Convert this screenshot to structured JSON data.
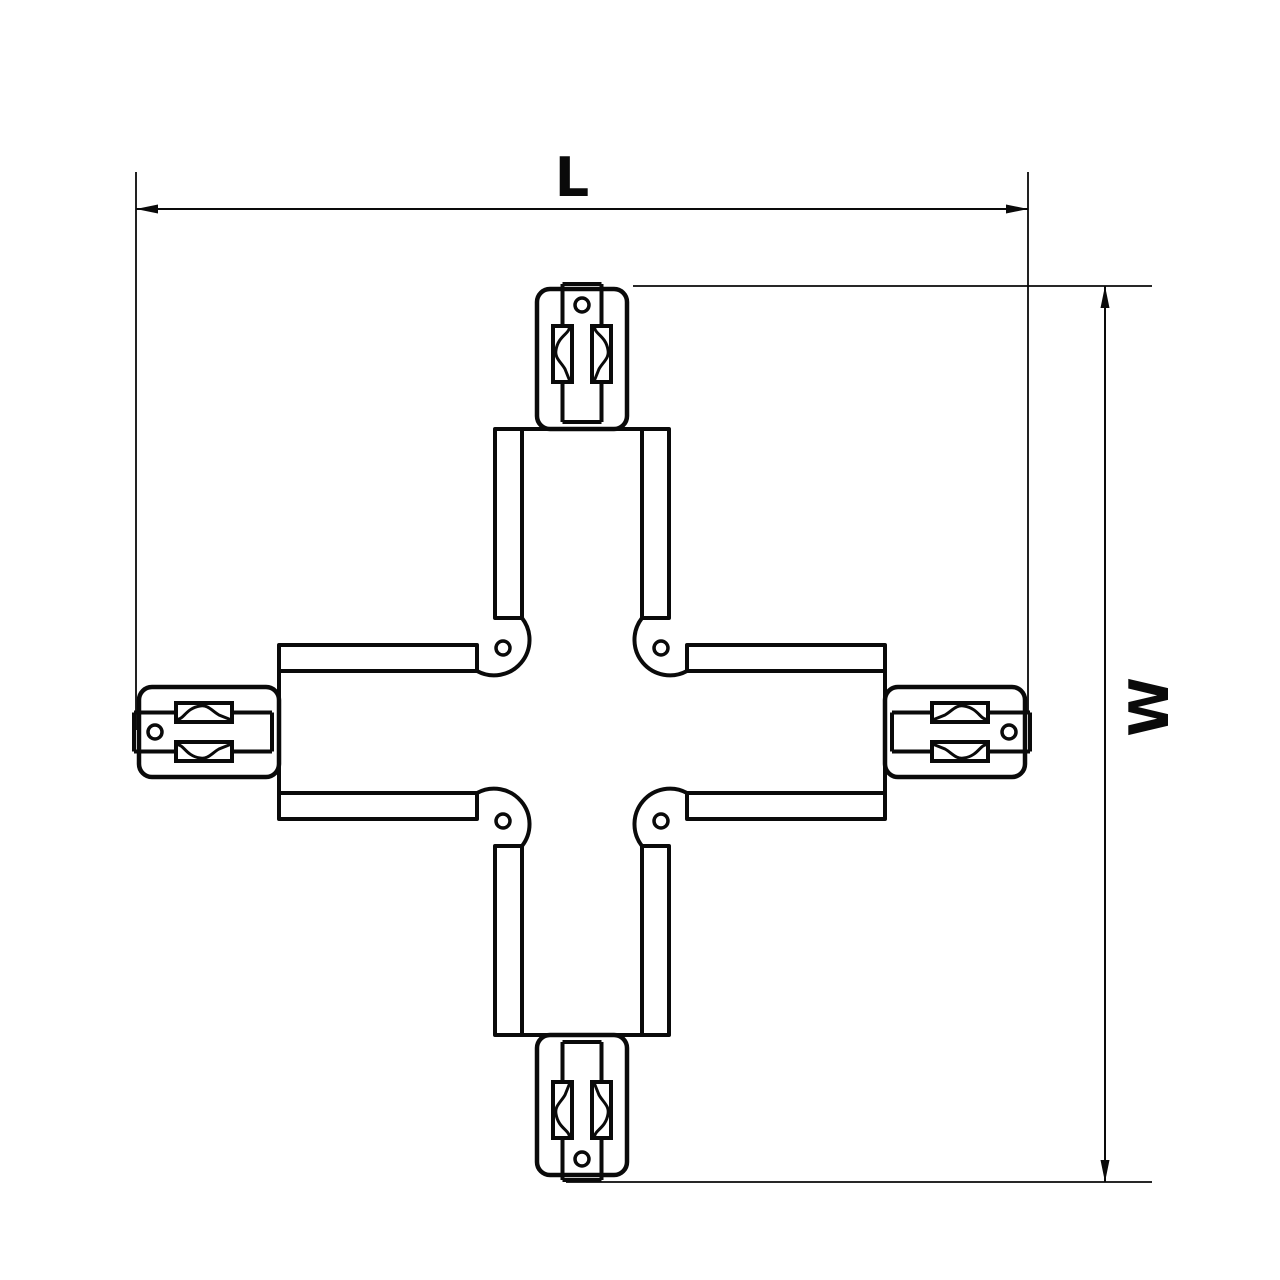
{
  "drawing": {
    "title": "X-shaped track connector dimensional drawing",
    "dimension_labels": {
      "length": "L",
      "width": "W"
    },
    "colors": {
      "line": "#0a0a0a",
      "background": "#ffffff"
    },
    "parts": {
      "cross_body": "four-way track connector body",
      "connector_plug": "end plug with contact tongue",
      "screw_hole": "fastening screw hole"
    }
  }
}
